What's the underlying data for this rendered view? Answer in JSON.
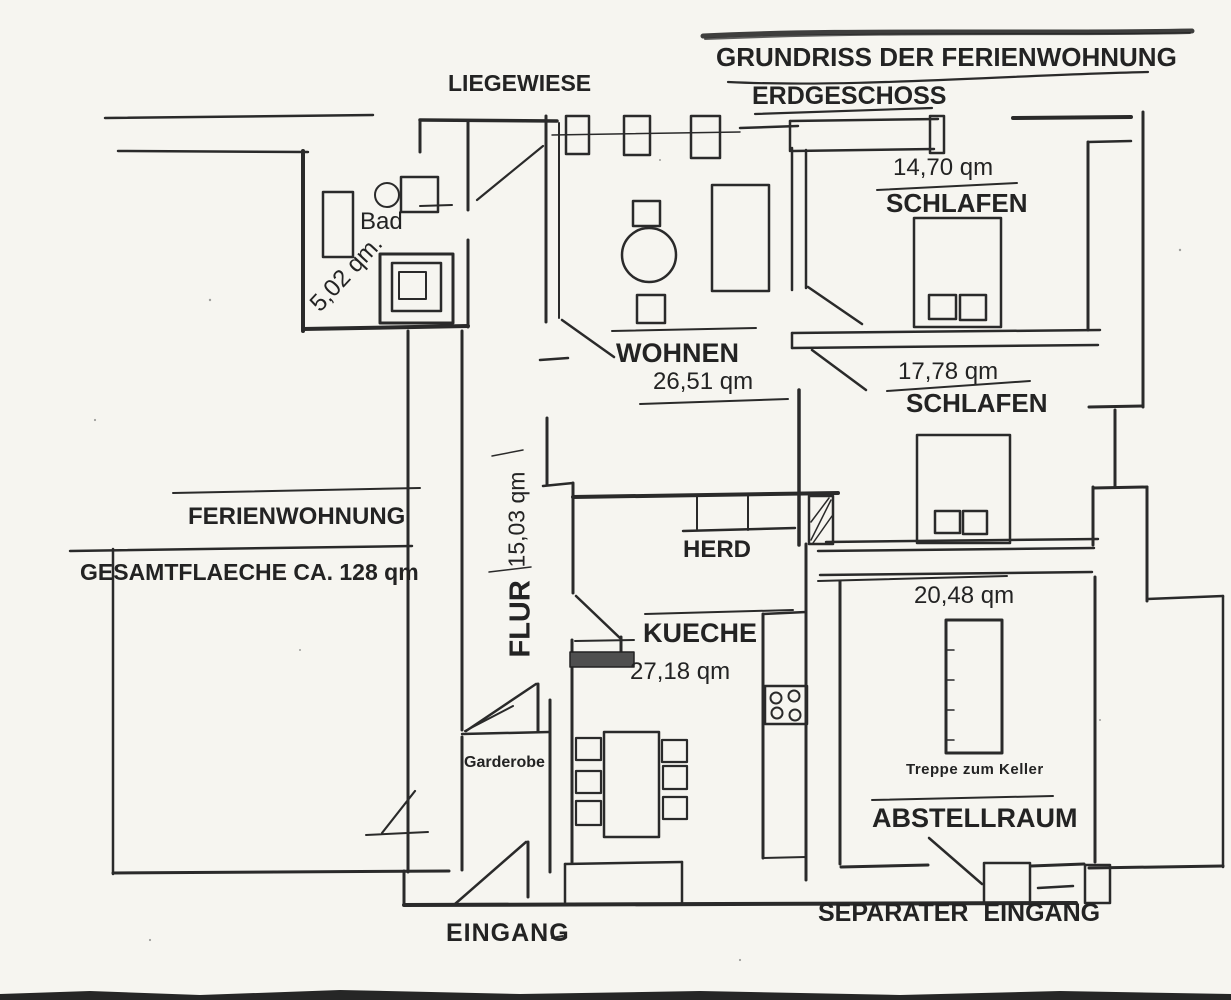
{
  "page": {
    "title": "GRUNDRISS DER FERIENWOHNUNG",
    "floor": "ERDGESCHOSS"
  },
  "outdoor": {
    "lawn": "LIEGEWIESE",
    "apartment_name": "FERIENWOHNUNG",
    "total_area": "GESAMTFLAECHE CA. 128 qm"
  },
  "rooms": {
    "bad": {
      "label": "Bad",
      "area": "5,02 qm."
    },
    "schlafen1": {
      "label": "SCHLAFEN",
      "area": "14,70 qm"
    },
    "wohnen": {
      "label": "WOHNEN",
      "area": "26,51 qm"
    },
    "schlafen2": {
      "label": "SCHLAFEN",
      "area": "17,78 qm"
    },
    "flur": {
      "label": "FLUR",
      "area": "15,03 qm"
    },
    "kueche": {
      "label": "KUECHE",
      "area": "27,18 qm"
    },
    "herd": {
      "label": "HERD"
    },
    "abstellraum": {
      "label": "ABSTELLRAUM",
      "area": "20,48 qm",
      "note": "Treppe zum Keller"
    },
    "garderobe": {
      "label": "Garderobe"
    }
  },
  "entrances": {
    "main": "EINGANG",
    "separate": "SEPARATER EINGANG"
  }
}
